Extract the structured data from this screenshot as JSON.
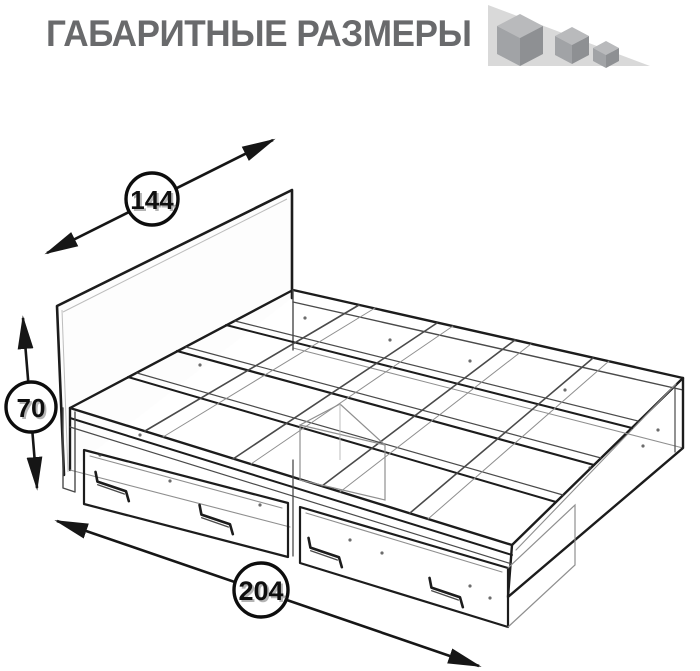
{
  "header": {
    "title": "ГАБАРИТНЫЕ РАЗМЕРЫ",
    "logo_icon": "shrinking-cubes-on-ramp"
  },
  "diagram": {
    "subject": "bed frame with two storage drawers",
    "view": "isometric wireframe drawing",
    "dimensions": {
      "width": {
        "value": "144"
      },
      "height": {
        "value": "70"
      },
      "length": {
        "value": "204"
      }
    }
  },
  "colors": {
    "title_text": "#696a6c",
    "drawing_lines": "#1c1c1c",
    "dimension_text": "#0f0f0f",
    "badge_fill": "#ffffff",
    "logo_triangle": "#d9d9d9",
    "logo_cube_top": "#b9babc",
    "logo_cube_left": "#a1a3a6",
    "logo_cube_right": "#8e9093",
    "background": "#ffffff"
  }
}
